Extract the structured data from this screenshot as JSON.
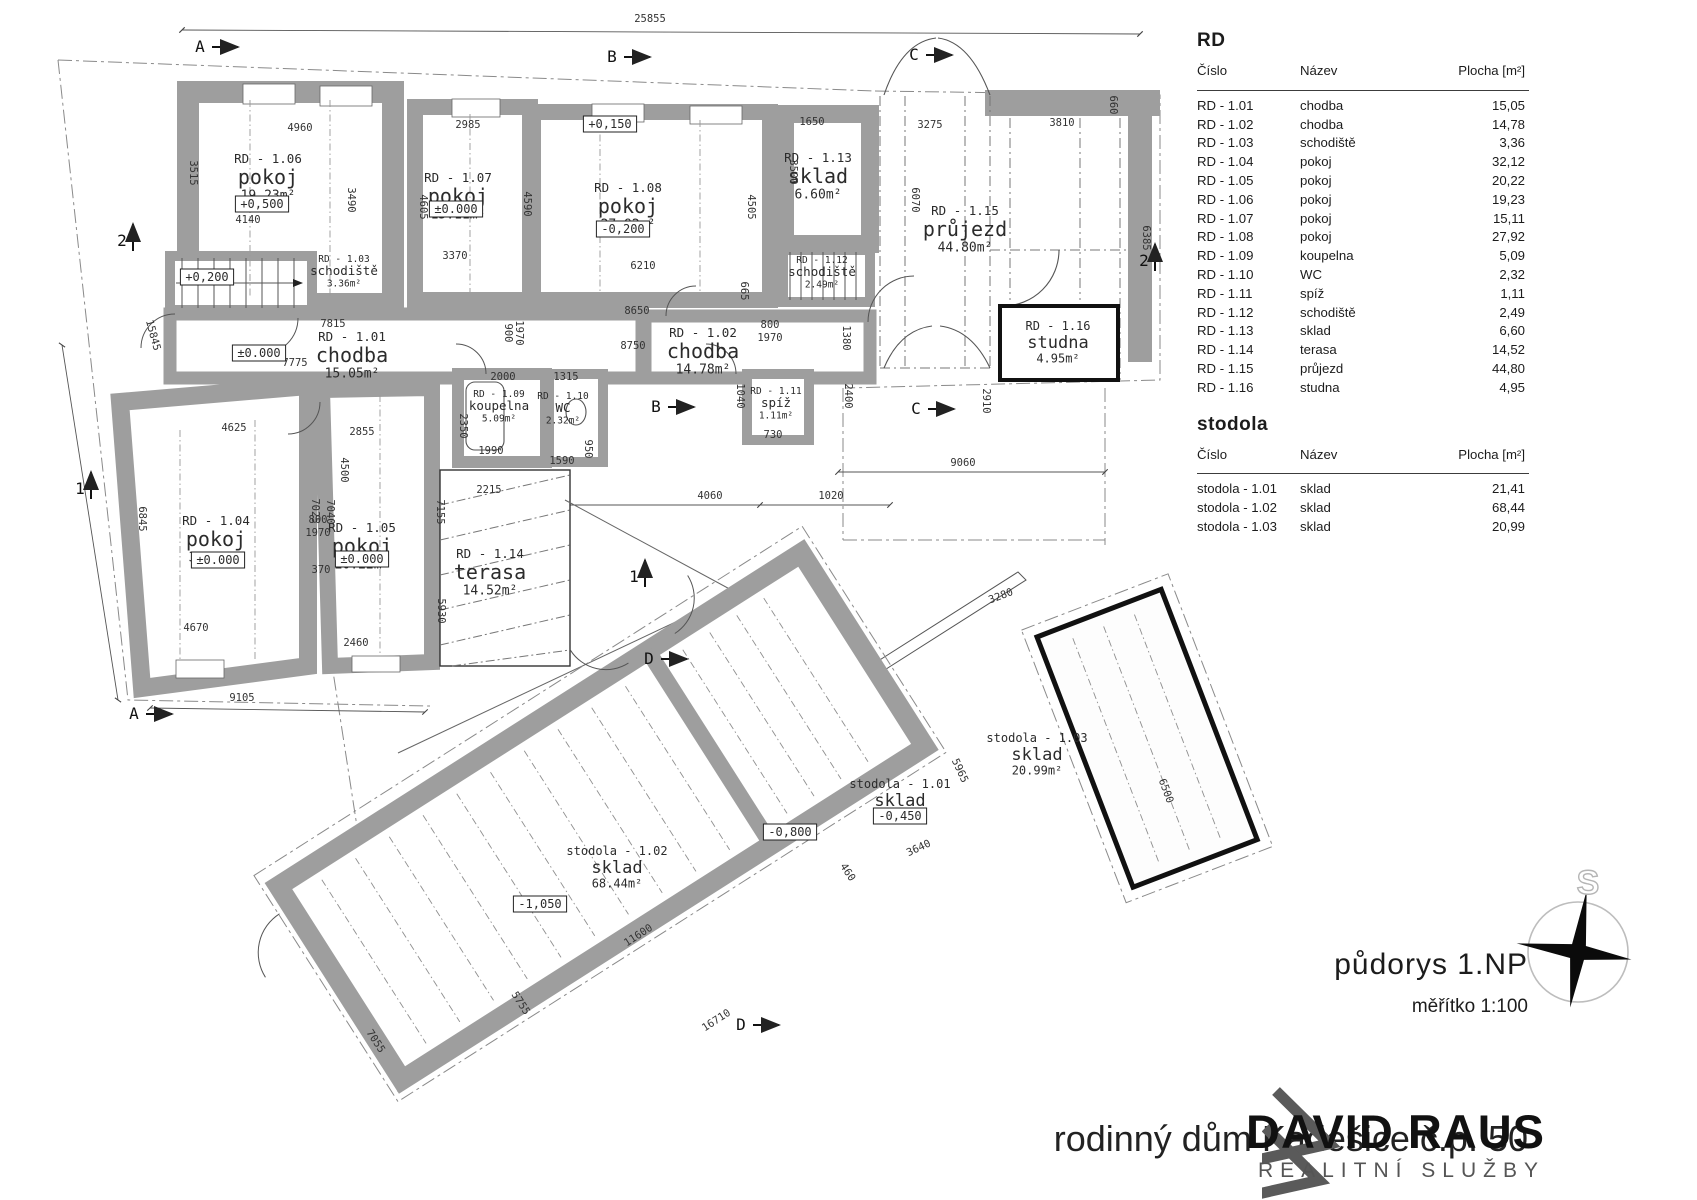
{
  "legend": {
    "rd": {
      "title": "RD",
      "columns": [
        "Číslo",
        "Název",
        "Plocha [m²]"
      ],
      "rows": [
        [
          "RD - 1.01",
          "chodba",
          "15,05"
        ],
        [
          "RD - 1.02",
          "chodba",
          "14,78"
        ],
        [
          "RD - 1.03",
          "schodiště",
          "3,36"
        ],
        [
          "RD - 1.04",
          "pokoj",
          "32,12"
        ],
        [
          "RD - 1.05",
          "pokoj",
          "20,22"
        ],
        [
          "RD - 1.06",
          "pokoj",
          "19,23"
        ],
        [
          "RD - 1.07",
          "pokoj",
          "15,11"
        ],
        [
          "RD - 1.08",
          "pokoj",
          "27,92"
        ],
        [
          "RD - 1.09",
          "koupelna",
          "5,09"
        ],
        [
          "RD - 1.10",
          "WC",
          "2,32"
        ],
        [
          "RD - 1.11",
          "spíž",
          "1,11"
        ],
        [
          "RD - 1.12",
          "schodiště",
          "2,49"
        ],
        [
          "RD - 1.13",
          "sklad",
          "6,60"
        ],
        [
          "RD - 1.14",
          "terasa",
          "14,52"
        ],
        [
          "RD - 1.15",
          "průjezd",
          "44,80"
        ],
        [
          "RD - 1.16",
          "studna",
          "4,95"
        ]
      ]
    },
    "stodola": {
      "title": "stodola",
      "columns": [
        "Číslo",
        "Název",
        "Plocha [m²]"
      ],
      "rows": [
        [
          "stodola - 1.01",
          "sklad",
          "21,41"
        ],
        [
          "stodola - 1.02",
          "sklad",
          "68,44"
        ],
        [
          "stodola - 1.03",
          "sklad",
          "20,99"
        ]
      ]
    }
  },
  "titleblock": {
    "drawing_title": "půdorys 1.NP",
    "scale": "měřítko 1:100",
    "project_title": "rodinný dům Kadešice č.p. 50"
  },
  "watermark": {
    "name": "DAVID RAUS",
    "subtitle": "REALITNÍ SLUŽBY"
  },
  "compass": {
    "north_label": "S"
  },
  "plan": {
    "rooms": [
      {
        "id": "RD - 1.06",
        "name": "pokoj",
        "area": "19.23m²",
        "x": 268,
        "y": 163,
        "size": "l"
      },
      {
        "id": "RD - 1.07",
        "name": "pokoj",
        "area": "15.11m²",
        "x": 458,
        "y": 182,
        "size": "l"
      },
      {
        "id": "RD - 1.08",
        "name": "pokoj",
        "area": "27.92m²",
        "x": 628,
        "y": 192,
        "size": "l"
      },
      {
        "id": "RD - 1.13",
        "name": "sklad",
        "area": "6.60m²",
        "x": 818,
        "y": 162,
        "size": "l"
      },
      {
        "id": "RD - 1.15",
        "name": "průjezd",
        "area": "44.80m²",
        "x": 965,
        "y": 215,
        "size": "l"
      },
      {
        "id": "RD - 1.16",
        "name": "studna",
        "area": "4.95m²",
        "x": 1058,
        "y": 330,
        "size": "m"
      },
      {
        "id": "RD - 1.03",
        "name": "schodiště",
        "area": "3.36m²",
        "x": 344,
        "y": 262,
        "size": "s"
      },
      {
        "id": "RD - 1.12",
        "name": "schodiště",
        "area": "2.49m²",
        "x": 822,
        "y": 263,
        "size": "s"
      },
      {
        "id": "RD - 1.01",
        "name": "chodba",
        "area": "15.05m²",
        "x": 352,
        "y": 341,
        "size": "l"
      },
      {
        "id": "RD - 1.02",
        "name": "chodba",
        "area": "14.78m²",
        "x": 703,
        "y": 337,
        "size": "l"
      },
      {
        "id": "RD - 1.09",
        "name": "koupelna",
        "area": "5.09m²",
        "x": 499,
        "y": 397,
        "size": "s"
      },
      {
        "id": "RD - 1.10",
        "name": "WC",
        "area": "2.32m²",
        "x": 563,
        "y": 399,
        "size": "s"
      },
      {
        "id": "RD - 1.11",
        "name": "spíž",
        "area": "1.11m²",
        "x": 776,
        "y": 394,
        "size": "s"
      },
      {
        "id": "RD - 1.04",
        "name": "pokoj",
        "area": "32.12m²",
        "x": 216,
        "y": 525,
        "size": "l"
      },
      {
        "id": "RD - 1.05",
        "name": "pokoj",
        "area": "20.22m²",
        "x": 362,
        "y": 532,
        "size": "l"
      },
      {
        "id": "RD - 1.14",
        "name": "terasa",
        "area": "14.52m²",
        "x": 490,
        "y": 558,
        "size": "l"
      },
      {
        "id": "stodola - 1.02",
        "name": "sklad",
        "area": "68.44m²",
        "x": 617,
        "y": 855,
        "size": "m"
      },
      {
        "id": "stodola - 1.01",
        "name": "sklad",
        "area": "21.41m²",
        "x": 900,
        "y": 788,
        "size": "m"
      },
      {
        "id": "stodola - 1.03",
        "name": "sklad",
        "area": "20.99m²",
        "x": 1037,
        "y": 742,
        "size": "m"
      }
    ],
    "elevations": [
      {
        "t": "+0,500",
        "x": 262,
        "y": 208
      },
      {
        "t": "±0.000",
        "x": 456,
        "y": 213
      },
      {
        "t": "-0,200",
        "x": 623,
        "y": 233
      },
      {
        "t": "+0,150",
        "x": 610,
        "y": 128
      },
      {
        "t": "+0,200",
        "x": 207,
        "y": 281
      },
      {
        "t": "±0.000",
        "x": 259,
        "y": 357
      },
      {
        "t": "±0.000",
        "x": 218,
        "y": 564
      },
      {
        "t": "±0.000",
        "x": 362,
        "y": 563
      },
      {
        "t": "-1,050",
        "x": 540,
        "y": 908
      },
      {
        "t": "-0,800",
        "x": 790,
        "y": 836
      },
      {
        "t": "-0,450",
        "x": 900,
        "y": 820
      }
    ],
    "dims": [
      {
        "t": "25855",
        "x": 650,
        "y": 22,
        "r": 0
      },
      {
        "t": "4960",
        "x": 300,
        "y": 131,
        "r": 0
      },
      {
        "t": "2985",
        "x": 468,
        "y": 128,
        "r": 0
      },
      {
        "t": "1650",
        "x": 812,
        "y": 125,
        "r": 0
      },
      {
        "t": "3275",
        "x": 930,
        "y": 128,
        "r": 0
      },
      {
        "t": "3810",
        "x": 1062,
        "y": 126,
        "r": 0
      },
      {
        "t": "660",
        "x": 1110,
        "y": 105,
        "r": 90
      },
      {
        "t": "3515",
        "x": 190,
        "y": 173,
        "r": 90
      },
      {
        "t": "3490",
        "x": 348,
        "y": 200,
        "r": 90
      },
      {
        "t": "4605",
        "x": 420,
        "y": 207,
        "r": 90
      },
      {
        "t": "4590",
        "x": 524,
        "y": 204,
        "r": 90
      },
      {
        "t": "3500",
        "x": 790,
        "y": 172,
        "r": 90
      },
      {
        "t": "4505",
        "x": 748,
        "y": 207,
        "r": 90
      },
      {
        "t": "6070",
        "x": 912,
        "y": 200,
        "r": 90
      },
      {
        "t": "6385",
        "x": 1143,
        "y": 238,
        "r": 90
      },
      {
        "t": "4140",
        "x": 248,
        "y": 223,
        "r": 0
      },
      {
        "t": "3370",
        "x": 455,
        "y": 259,
        "r": 0
      },
      {
        "t": "6210",
        "x": 643,
        "y": 269,
        "r": 0
      },
      {
        "t": "8650",
        "x": 637,
        "y": 314,
        "r": 0
      },
      {
        "t": "8750",
        "x": 633,
        "y": 349,
        "r": 0
      },
      {
        "t": "7815",
        "x": 333,
        "y": 327,
        "r": 0
      },
      {
        "t": "7775",
        "x": 295,
        "y": 366,
        "r": 0
      },
      {
        "t": "665",
        "x": 741,
        "y": 291,
        "r": 90
      },
      {
        "t": "1380",
        "x": 843,
        "y": 338,
        "r": 90
      },
      {
        "t": "2400",
        "x": 845,
        "y": 396,
        "r": 90
      },
      {
        "t": "2910",
        "x": 983,
        "y": 401,
        "r": 90
      },
      {
        "t": "1040",
        "x": 737,
        "y": 396,
        "r": 90
      },
      {
        "t": "730",
        "x": 773,
        "y": 438,
        "r": 0
      },
      {
        "t": "800",
        "x": 770,
        "y": 328,
        "r": 0
      },
      {
        "t": "1970",
        "x": 770,
        "y": 341,
        "r": 0
      },
      {
        "t": "800",
        "x": 318,
        "y": 523,
        "r": 0
      },
      {
        "t": "1970",
        "x": 318,
        "y": 536,
        "r": 0
      },
      {
        "t": "900",
        "x": 505,
        "y": 333,
        "r": 90
      },
      {
        "t": "1970",
        "x": 516,
        "y": 333,
        "r": 90
      },
      {
        "t": "2000",
        "x": 503,
        "y": 380,
        "r": 0
      },
      {
        "t": "1315",
        "x": 566,
        "y": 380,
        "r": 0
      },
      {
        "t": "2350",
        "x": 460,
        "y": 426,
        "r": 90
      },
      {
        "t": "1990",
        "x": 491,
        "y": 454,
        "r": 0
      },
      {
        "t": "1590",
        "x": 562,
        "y": 464,
        "r": 0
      },
      {
        "t": "2215",
        "x": 489,
        "y": 493,
        "r": 0
      },
      {
        "t": "950",
        "x": 585,
        "y": 449,
        "r": 90
      },
      {
        "t": "4625",
        "x": 234,
        "y": 431,
        "r": 0
      },
      {
        "t": "2855",
        "x": 362,
        "y": 435,
        "r": 0
      },
      {
        "t": "6845",
        "x": 139,
        "y": 519,
        "r": 90
      },
      {
        "t": "7025",
        "x": 312,
        "y": 511,
        "r": 90
      },
      {
        "t": "7040",
        "x": 327,
        "y": 512,
        "r": 90
      },
      {
        "t": "7155",
        "x": 437,
        "y": 512,
        "r": 90
      },
      {
        "t": "4500",
        "x": 341,
        "y": 470,
        "r": 90
      },
      {
        "t": "370",
        "x": 321,
        "y": 573,
        "r": 0
      },
      {
        "t": "5930",
        "x": 438,
        "y": 611,
        "r": 90
      },
      {
        "t": "4670",
        "x": 196,
        "y": 631,
        "r": 0
      },
      {
        "t": "2460",
        "x": 356,
        "y": 646,
        "r": 0
      },
      {
        "t": "9105",
        "x": 242,
        "y": 701,
        "r": 0
      },
      {
        "t": "15845",
        "x": 150,
        "y": 336,
        "r": 75
      },
      {
        "t": "4060",
        "x": 710,
        "y": 499,
        "r": 0
      },
      {
        "t": "1020",
        "x": 831,
        "y": 499,
        "r": 0
      },
      {
        "t": "9060",
        "x": 963,
        "y": 466,
        "r": 0
      },
      {
        "t": "16710",
        "x": 718,
        "y": 1023,
        "r": -33
      },
      {
        "t": "11600",
        "x": 640,
        "y": 938,
        "r": -33
      },
      {
        "t": "5755",
        "x": 518,
        "y": 1005,
        "r": 57
      },
      {
        "t": "7055",
        "x": 373,
        "y": 1043,
        "r": 57
      },
      {
        "t": "5965",
        "x": 957,
        "y": 772,
        "r": 65
      },
      {
        "t": "3640",
        "x": 920,
        "y": 851,
        "r": -25
      },
      {
        "t": "460",
        "x": 845,
        "y": 874,
        "r": 57
      },
      {
        "t": "3280",
        "x": 1002,
        "y": 599,
        "r": -21
      },
      {
        "t": "6500",
        "x": 1163,
        "y": 792,
        "r": 70
      }
    ],
    "markers": [
      {
        "t": "A",
        "x": 200,
        "y": 52,
        "d": "r"
      },
      {
        "t": "B",
        "x": 612,
        "y": 62,
        "d": "r"
      },
      {
        "t": "C",
        "x": 914,
        "y": 60,
        "d": "r"
      },
      {
        "t": "A",
        "x": 134,
        "y": 719,
        "d": "r"
      },
      {
        "t": "B",
        "x": 656,
        "y": 412,
        "d": "r"
      },
      {
        "t": "C",
        "x": 916,
        "y": 414,
        "d": "r"
      },
      {
        "t": "D",
        "x": 649,
        "y": 664,
        "d": "r"
      },
      {
        "t": "D",
        "x": 741,
        "y": 1030,
        "d": "r"
      },
      {
        "t": "1",
        "x": 80,
        "y": 494,
        "d": "u"
      },
      {
        "t": "1",
        "x": 634,
        "y": 582,
        "d": "u"
      },
      {
        "t": "2",
        "x": 122,
        "y": 246,
        "d": "u"
      },
      {
        "t": "2",
        "x": 1144,
        "y": 266,
        "d": "u"
      }
    ]
  }
}
